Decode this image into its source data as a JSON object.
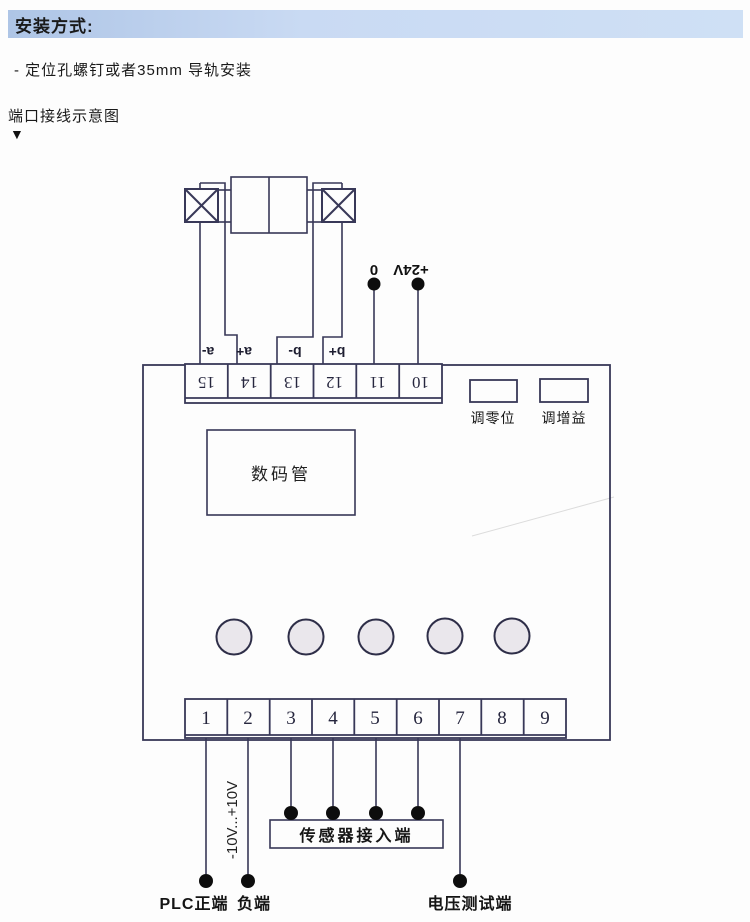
{
  "page": {
    "title": "安装方式:",
    "bullet": "- 定位孔螺钉或者35mm 导轨安装",
    "subtitle": "端口接线示意图",
    "pointer": "▼"
  },
  "diagram": {
    "display": "数码管",
    "pot_zero": "调零位",
    "pot_gain": "调增益",
    "top_terminals": [
      "15",
      "14",
      "13",
      "12",
      "11",
      "10"
    ],
    "coil_labels": [
      "a-",
      "a+",
      "b-",
      "b+"
    ],
    "supply_zero": "0",
    "supply_24v": "+24V",
    "bottom_terminals": [
      "1",
      "2",
      "3",
      "4",
      "5",
      "6",
      "7",
      "8",
      "9"
    ],
    "range": "-10V...+10V",
    "sensor_box": "传感器接入端",
    "plc_pos": "PLC正端",
    "neg": "负端",
    "volt_test": "电压测试端"
  },
  "colors": {
    "banner_from": "#aec5e6",
    "banner_to": "#cfe0f5",
    "line": "#383858",
    "dot": "#0d0d0d",
    "button_fill": "#eae7ec"
  }
}
